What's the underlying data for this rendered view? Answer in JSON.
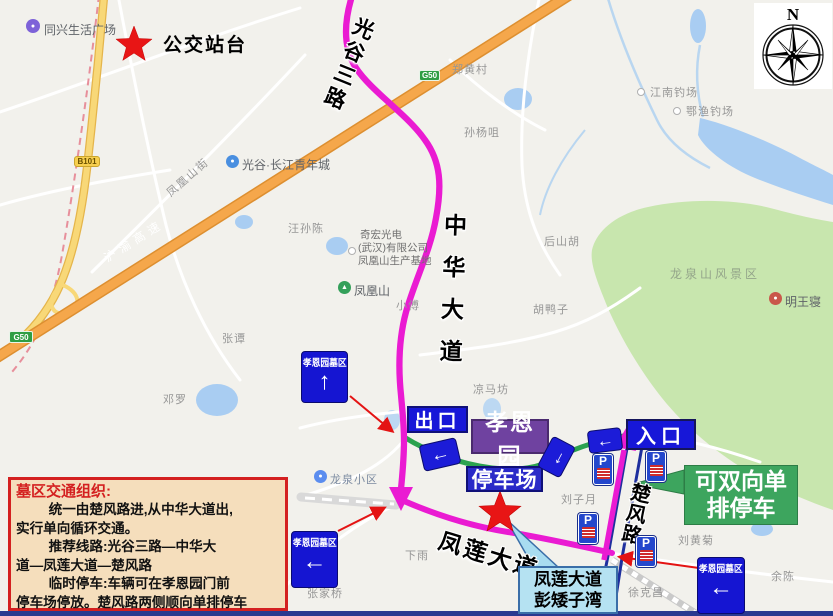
{
  "legend": {
    "bus_station": "公交站台"
  },
  "compass": {
    "north": "N"
  },
  "badges": {
    "b101": "B101",
    "g50": "G50"
  },
  "roads": {
    "guanggu3": "光谷三路",
    "zhonghua": "中华大道",
    "chufeng": "楚风路",
    "fenglian": "凤莲大道",
    "fenghuangshan_st": "凤凰山街",
    "huyu_expwy": "沪渝高速"
  },
  "signs": {
    "cemetery": "孝恩园墓区",
    "exit": "出口",
    "garden": "孝恩园",
    "parking_lot": "停车场",
    "entrance": "入口",
    "p": "P"
  },
  "glyphs": {
    "up_arrow": "↑",
    "left_arrow": "←"
  },
  "callouts": {
    "green": {
      "line1": "可双向单",
      "line2": "排停车"
    },
    "cyan": {
      "line1": "凤莲大道",
      "line2": "彭矮子湾"
    }
  },
  "info_box": {
    "title": "墓区交通组织:",
    "lines": [
      "统一由楚风路进,从中华大道出,",
      "实行单向循环交通。",
      "推荐线路:光谷三路—中华大",
      "道—凤莲大道—楚风路",
      "临时停车:车辆可在孝恩园门前",
      "停车场停放。楚风路两侧顺向单排停车"
    ]
  },
  "places": {
    "tongxing": "同兴生活广场",
    "zhenghuang": "郑黄村",
    "sunyangju": "孙杨咀",
    "jiangnan": "江南钓场",
    "eyu": "鄂渔钓场",
    "guanggu_city": "光谷·长江青年城",
    "wangsunchen": "汪孙陈",
    "qihong_l1": "奇宏光电",
    "qihong_l2": "(武汉)有限公司",
    "qihong_l3": "凤凰山生产基地",
    "fenghuangshan": "凤凰山",
    "xiaofu": "小傅",
    "houshanhu": "后山胡",
    "huyazi": "胡鸭子",
    "longquanshan": "龙泉山风景区",
    "mingwangqin": "明王寝",
    "zhangtan": "张谭",
    "liangmafang": "凉马坊",
    "dengluo": "邓罗",
    "longquan_xq": "龙泉小区",
    "liuziyue": "刘子月",
    "liuhuangju": "刘黄菊",
    "xiayu": "下雨",
    "zhangjiaqiao": "张家桥",
    "xukechang": "徐克昌",
    "yuchen": "余陈"
  },
  "colors": {
    "route_magenta": "#ea1bd2",
    "route_green": "#2ba24f",
    "sign_blue": "#1717d8",
    "sign_purple": "#6f42a0",
    "callout_green": "#3da55e",
    "callout_cyan": "#b5e2f2",
    "highway_orange": "#f5a74b",
    "star_red": "#e81515",
    "info_bg": "#f5debc",
    "info_border": "#d42020"
  }
}
